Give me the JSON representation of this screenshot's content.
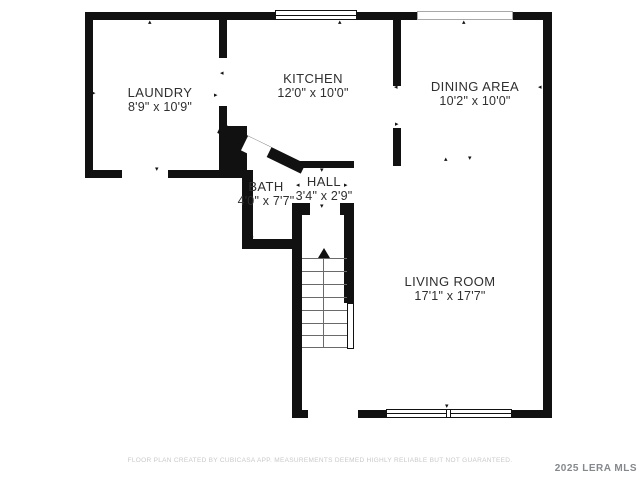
{
  "title": "First floor plan",
  "rooms": [
    {
      "id": "laundry",
      "name": "LAUNDRY",
      "dimensions": "8'9\" x 10'9\""
    },
    {
      "id": "kitchen",
      "name": "KITCHEN",
      "dimensions": "12'0\" x 10'0\""
    },
    {
      "id": "dining",
      "name": "DINING AREA",
      "dimensions": "10'2\" x 10'0\""
    },
    {
      "id": "bath",
      "name": "BATH",
      "dimensions": "4'0\" x 7'7\""
    },
    {
      "id": "hall",
      "name": "HALL",
      "dimensions": "3'4\" x 2'9\""
    },
    {
      "id": "living",
      "name": "LIVING ROOM",
      "dimensions": "17'1\" x 17'7\""
    }
  ],
  "stairs": {
    "direction": "up",
    "step_count": 8
  },
  "icons": {
    "tick_up": "▴",
    "tick_down": "▾",
    "tick_left": "◂",
    "tick_right": "▸"
  },
  "colors": {
    "wall": "#111111",
    "label_text": "#2f2f2f",
    "disclaimer_text": "#c9c9c9",
    "branding_text": "#84898d"
  },
  "footer": {
    "disclaimer": "FLOOR PLAN CREATED BY CUBICASA APP. MEASUREMENTS DEEMED HIGHLY RELIABLE BUT NOT GUARANTEED.",
    "branding": "2025 LERA MLS"
  }
}
